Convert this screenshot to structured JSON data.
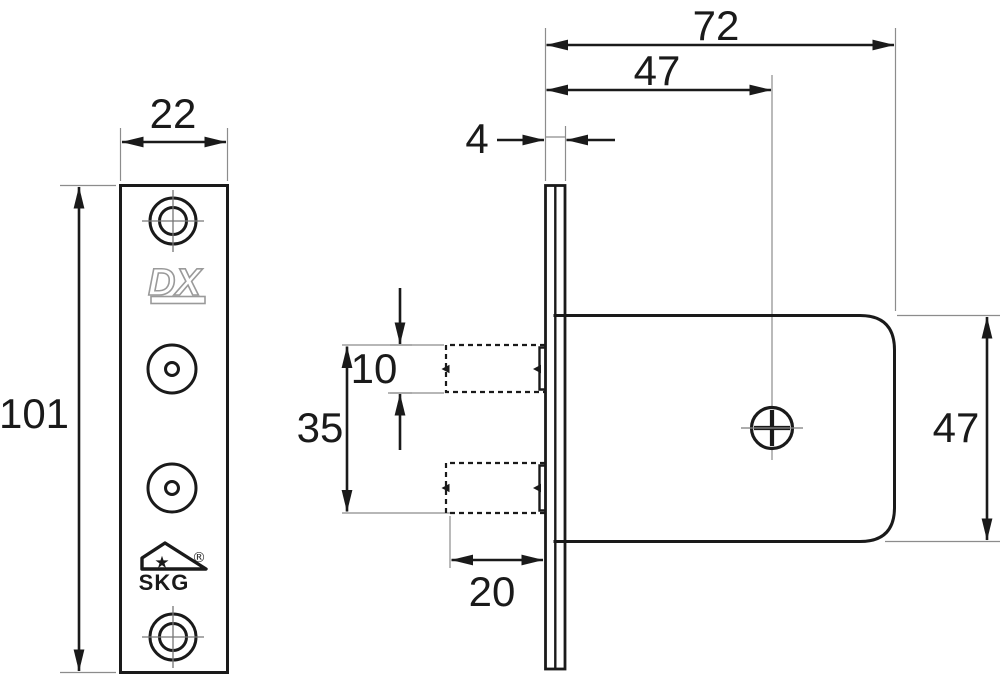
{
  "views": {
    "front": {
      "width": "22",
      "height": "101",
      "brand_logo": "DX",
      "cert_logo": "SKG",
      "registered": "®",
      "star": "★"
    },
    "side": {
      "total_depth": "72",
      "backset": "47",
      "faceplate_thickness": "4",
      "pin_height": "10",
      "pin_span": "35",
      "pin_protrusion": "20",
      "case_height": "47"
    }
  }
}
